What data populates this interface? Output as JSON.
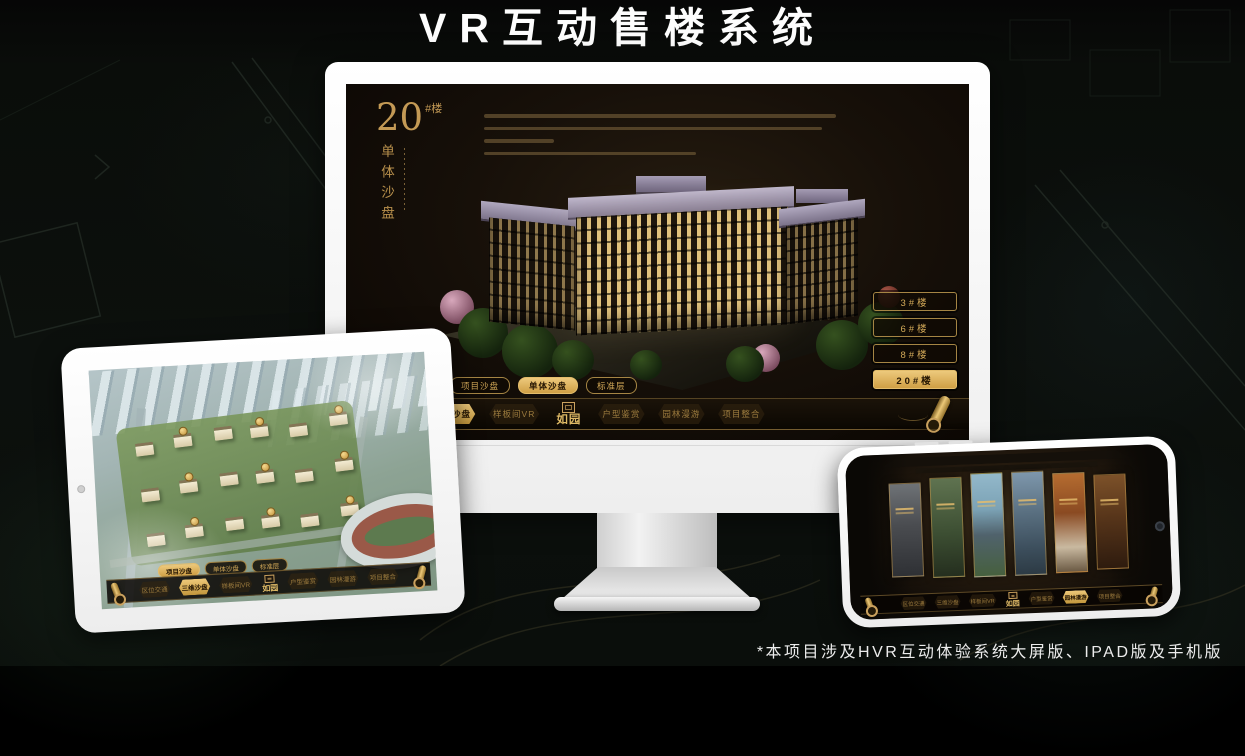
{
  "page": {
    "title": "VR互动售楼系统",
    "footnote": "*本项目涉及HVR互动体验系统大屏版、IPAD版及手机版"
  },
  "brand": {
    "logo": "如园"
  },
  "colors": {
    "gold": "#d2a855",
    "gold_active": "#e8c276",
    "screen_bg": "#15100a",
    "device_white": "#f4f4f4"
  },
  "nav": {
    "sub_tabs": [
      "项目沙盘",
      "单体沙盘",
      "标准层"
    ],
    "items": [
      "区位交通",
      "三维沙盘",
      "样板间VR",
      "户型鉴赏",
      "园林漫游",
      "项目整合"
    ]
  },
  "monitor": {
    "block": {
      "number": "20",
      "suffix": "#楼",
      "subtitle": "单体沙盘"
    },
    "floor_buttons": [
      "3#楼",
      "6#楼",
      "8#楼",
      "20#楼"
    ]
  }
}
